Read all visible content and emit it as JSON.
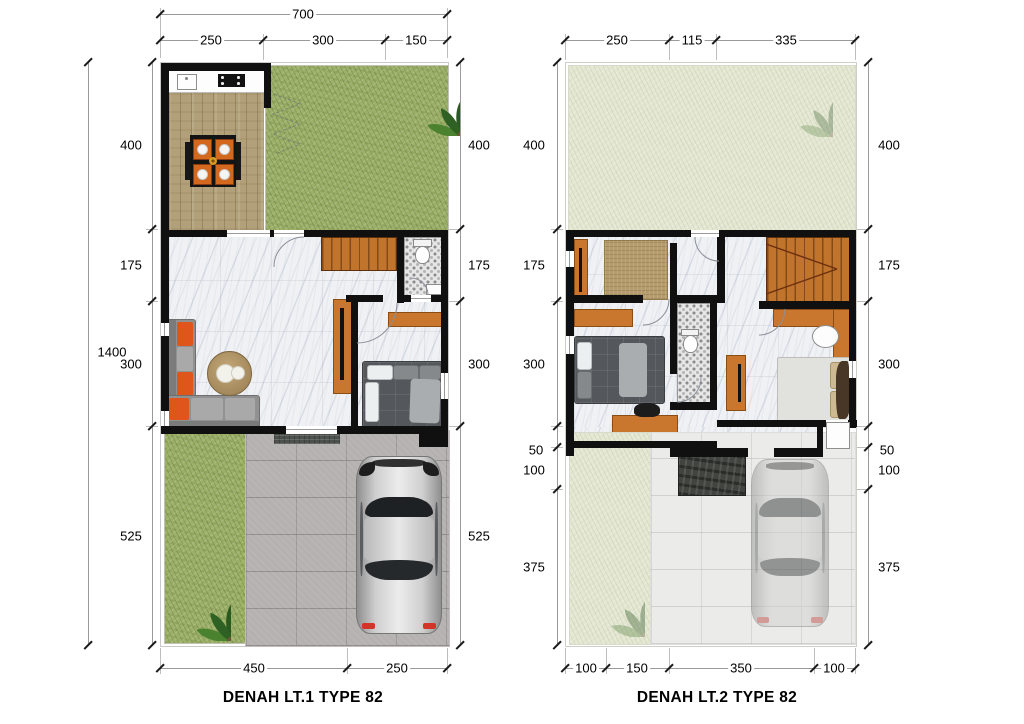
{
  "plans": [
    {
      "caption": "DENAH LT.1 TYPE 82",
      "dims": {
        "top_total": "700",
        "top_segments": [
          "250",
          "300",
          "150"
        ],
        "left_total": "1400",
        "left_segments": [
          "400",
          "175",
          "300",
          "525"
        ],
        "right_segments": [
          "400",
          "175",
          "300",
          "525"
        ],
        "bottom_segments": [
          "450",
          "250"
        ]
      }
    },
    {
      "caption": "DENAH LT.2 TYPE 82",
      "dims": {
        "top_segments": [
          "250",
          "115",
          "335"
        ],
        "left_segments": [
          "400",
          "175",
          "300",
          "50",
          "100",
          "375"
        ],
        "right_segments": [
          "400",
          "175",
          "300",
          "50",
          "100",
          "375"
        ],
        "bottom_segments": [
          "100",
          "150",
          "350",
          "100"
        ]
      }
    }
  ],
  "colors": {
    "wall": "#101010",
    "grass": "#9cb069",
    "grass_faded": "#e3e6d1",
    "wood_floor": "#b1a079",
    "marble_floor": "#eff1f4",
    "stairs": "#c0742c",
    "furniture_orange": "#c9772e",
    "sofa_gray": "#919191",
    "cushion_orange": "#e0551c",
    "paving": "#b4b1b0",
    "paving_faded": "#ebebe9",
    "canopy": "#42453f",
    "dimension_line": "#9a9a9a",
    "text": "#000000"
  }
}
